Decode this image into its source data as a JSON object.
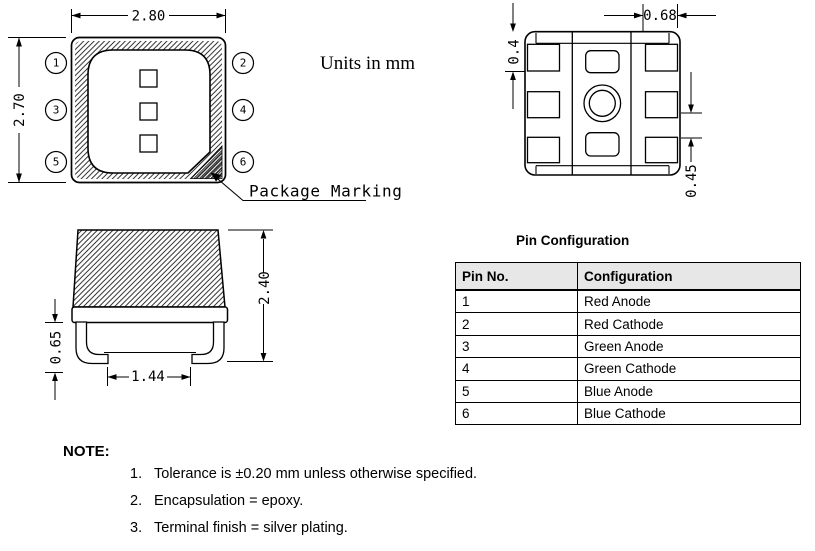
{
  "drawing": {
    "units_note": "Units in mm",
    "top_view": {
      "dim_width": "2.80",
      "dim_height": "2.70",
      "pins": [
        "1",
        "2",
        "3",
        "4",
        "5",
        "6"
      ],
      "marking_label": "Package Marking"
    },
    "bottom_view": {
      "dim_pad_length": "0.68",
      "dim_pad_width": "0.4",
      "dim_pad_gap": "0.45"
    },
    "side_view": {
      "dim_total_height": "2.40",
      "dim_standoff": "0.65",
      "dim_lead_span": "1.44"
    }
  },
  "pin_table": {
    "title": "Pin Configuration",
    "headers": [
      "Pin No.",
      "Configuration"
    ],
    "rows": [
      [
        "1",
        "Red Anode"
      ],
      [
        "2",
        "Red Cathode"
      ],
      [
        "3",
        "Green Anode"
      ],
      [
        "4",
        "Green Cathode"
      ],
      [
        "5",
        "Blue Anode"
      ],
      [
        "6",
        "Blue Cathode"
      ]
    ]
  },
  "notes": {
    "label": "NOTE:",
    "items": [
      {
        "num": "1.",
        "text": "Tolerance is ±0.20 mm unless otherwise specified."
      },
      {
        "num": "2.",
        "text": "Encapsulation = epoxy."
      },
      {
        "num": "3.",
        "text": "Terminal finish = silver plating."
      }
    ]
  }
}
